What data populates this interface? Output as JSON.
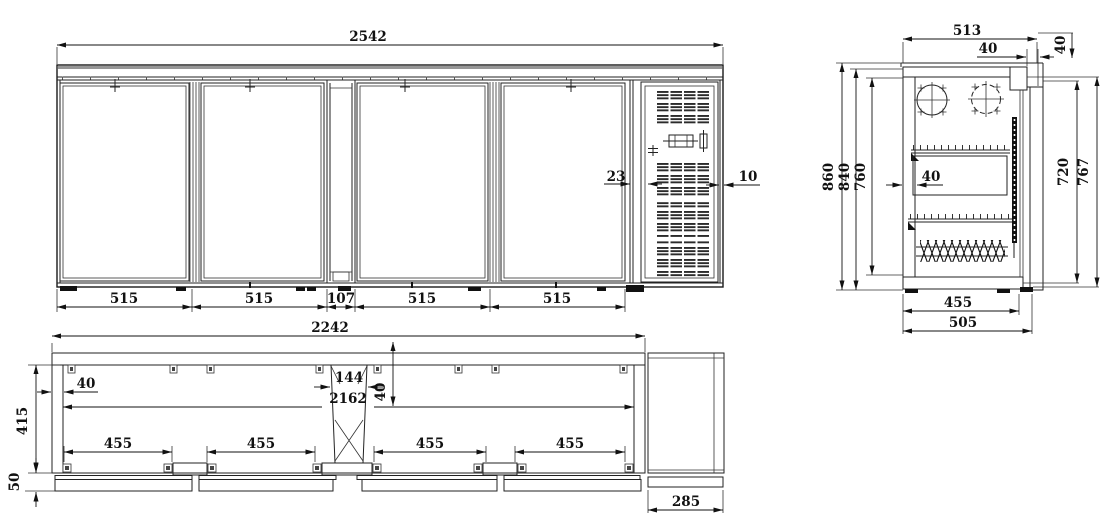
{
  "drawing": {
    "type": "technical-drawing-back-bar-cooler",
    "front_view": {
      "overall_width": "2542",
      "segments": [
        "515",
        "515",
        "107",
        "515",
        "515"
      ],
      "vent_gap": "23",
      "vent_edge": "10"
    },
    "side_view": {
      "overall_depth": "513",
      "door_thickness": "40",
      "top_offset": "40",
      "overall_height": "860",
      "cabinet_height": "840",
      "interior_height": "760",
      "wall_thickness": "40",
      "door_inner_height": "720",
      "door_outer_height": "767",
      "interior_depth": "455",
      "base_depth": "505"
    },
    "plan_view": {
      "body_length": "2242",
      "wall_thickness": "40",
      "mullion_width": "144",
      "interior_length": "2162",
      "offset": "40",
      "interior_depth": "415",
      "front_offset": "50",
      "openings": [
        "455",
        "455",
        "455",
        "455"
      ],
      "machine_depth": "285"
    }
  }
}
